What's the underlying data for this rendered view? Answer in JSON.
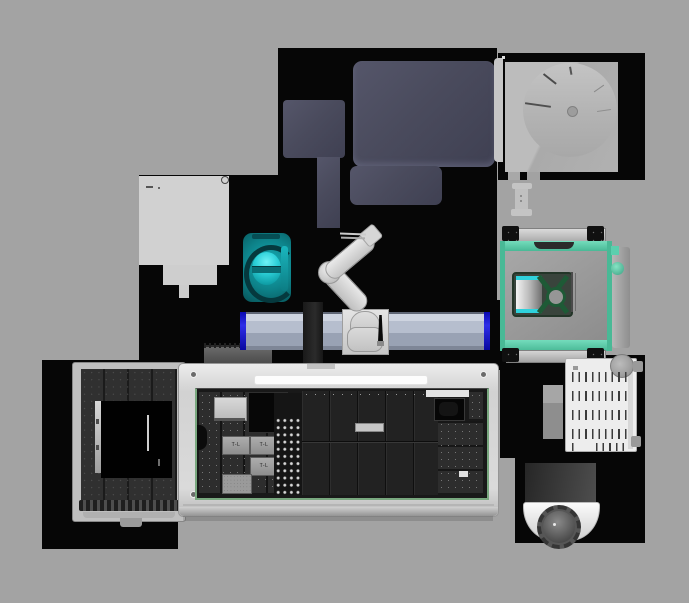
{
  "scene": {
    "name": "lab-automation-workcell-top-view",
    "width": 689,
    "height": 603,
    "view": "top-down 3d render"
  },
  "colors": {
    "bg": "#a3a3a3",
    "bench": "#060606",
    "slate": "#4a4b5d",
    "railSteel": "#b7bfd0",
    "railBlue": "#2222dd",
    "teal": "#11a3ab",
    "tealBright": "#49e8ee",
    "tealDark": "#05393e",
    "mint": "#5ccfae",
    "mintDark": "#2f8f72",
    "crossGreen": "#1e5a36",
    "greenLine": "#79a87f",
    "enclosureWhite": "#d9d9d9",
    "deckDark": "#191919",
    "carrier": "#2d2d2d"
  },
  "labels": {
    "plates": [
      "T-L",
      "T-L",
      "T-L"
    ]
  },
  "equipment": {
    "robot_arm": {
      "type": "articulated-arm-on-rail",
      "color": "#d8d8d8"
    },
    "linear_rail": {
      "end_caps": "blue",
      "length_px": 250
    },
    "plate_carousel": {
      "shape": "semicircle-with-radial-ticks"
    },
    "teal_imager": {
      "color": "teal",
      "lens": "glowing-cyan"
    },
    "transfer_station": {
      "frame": "mint",
      "viewport": "x-cross-with-ring"
    },
    "liquid_handler": {
      "enclosure": "white-with-green-inner-border",
      "tube_rack": {
        "columns": 4,
        "rows": 11
      },
      "labeled_plates": 3,
      "well_plate": {
        "grid": "96-well"
      }
    },
    "left_instrument": {
      "deck": "breadboard-dots",
      "opening": "black-square"
    },
    "vent_grille_device": {
      "slat_rows": 5,
      "slats_per_row": 9
    },
    "mobile_robot": {
      "turntable": "scalloped-gear",
      "body": "white"
    }
  }
}
